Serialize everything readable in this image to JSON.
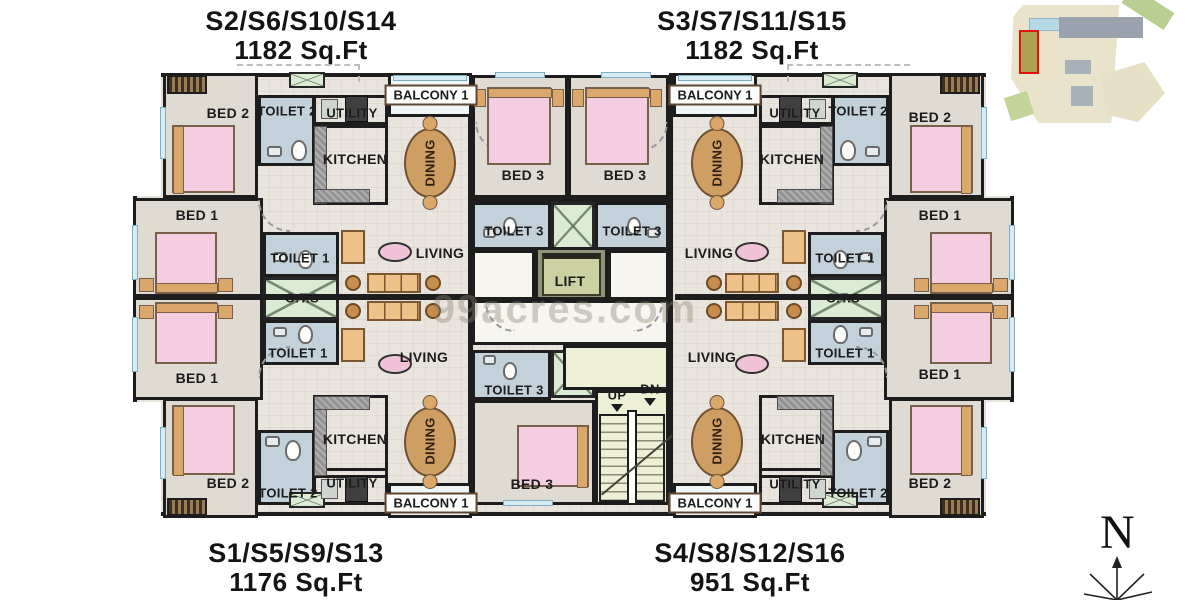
{
  "units": [
    {
      "id": "S2",
      "label": "S2/S6/S10/S14",
      "area": "1182 Sq.Ft",
      "position": "top-left"
    },
    {
      "id": "S3",
      "label": "S3/S7/S11/S15",
      "area": "1182 Sq.Ft",
      "position": "top-right"
    },
    {
      "id": "S1",
      "label": "S1/S5/S9/S13",
      "area": "1176 Sq.Ft",
      "position": "bottom-left"
    },
    {
      "id": "S4",
      "label": "S4/S8/S12/S16",
      "area": "951 Sq.Ft",
      "position": "bottom-right"
    }
  ],
  "rooms": {
    "bed1": "BED 1",
    "bed2": "BED 2",
    "bed3": "BED 3",
    "toilet1": "TOILET 1",
    "toilet2": "TOILET 2",
    "toilet3": "TOILET 3",
    "kitchen": "KITCHEN",
    "utility": "UTILITY",
    "living": "LIVING",
    "dining": "DINING",
    "balcony1": "BALCONY 1",
    "ots": "O.T.S",
    "lift": "LIFT"
  },
  "stairs": {
    "up": "UP",
    "dn": "DN"
  },
  "compass": {
    "north": "N"
  },
  "watermark": {
    "text": "99acres.com"
  },
  "colors": {
    "wall": "#1d1d1d",
    "hall_floor": "#e9e5de",
    "bedroom_floor": "#dfdbd3",
    "toilet_floor": "#c3d1da",
    "balcony_floor": "#f0f5f6",
    "stair_floor": "#eef0d6",
    "ots_green": "#dcebd3",
    "bed_pink": "#f4cde0",
    "wood_tan": "#dca76b",
    "dining_wood": "#cf9e62",
    "counter_gray": "#939393",
    "lift_olive": "#ccd1a3",
    "site_highlight_outline": "#e31408"
  }
}
